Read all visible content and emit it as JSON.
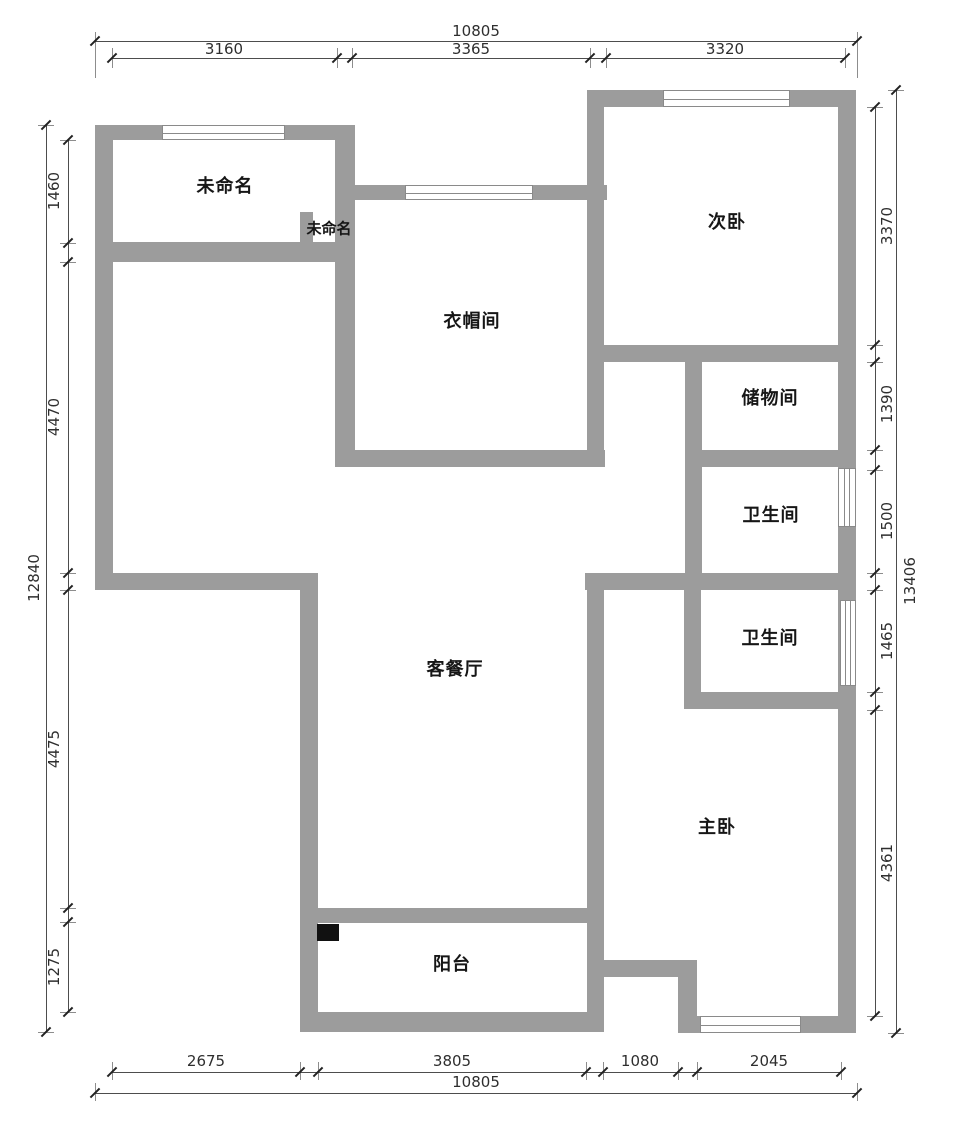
{
  "colors": {
    "wall": "#9c9c9c",
    "flue": "#111111",
    "text": "#161616",
    "dim": "#2e2e2e"
  },
  "rooms": {
    "unnamed_top": "未命名",
    "unnamed_small": "未命名",
    "cloakroom": "衣帽间",
    "second_bedroom": "次卧",
    "storage": "储物间",
    "bath_upper": "卫生间",
    "bath_lower": "卫生间",
    "living_dining": "客餐厅",
    "master_bedroom": "主卧",
    "balcony": "阳台"
  },
  "dims": {
    "top_total": "10805",
    "top_segments": [
      "3160",
      "3365",
      "3320"
    ],
    "bottom_total": "10805",
    "bottom_segments": [
      "2675",
      "3805",
      "1080",
      "2045"
    ],
    "left_total": "12840",
    "left_segments": [
      "1460",
      "4470",
      "4475",
      "1275"
    ],
    "right_total": "13406",
    "right_segments": [
      "3370",
      "1390",
      "1500",
      "1465",
      "4361"
    ]
  }
}
